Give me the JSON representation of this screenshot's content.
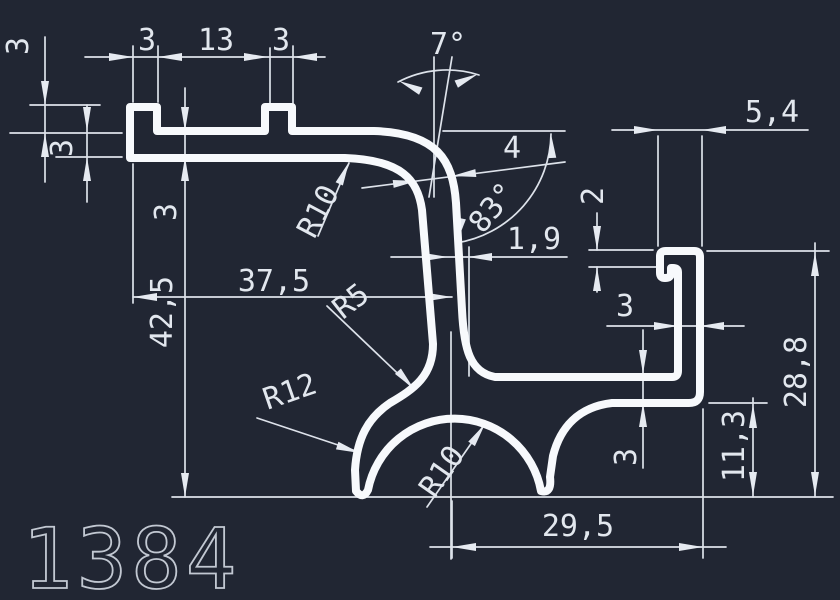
{
  "part_number": "1384",
  "colors": {
    "background": "#212633",
    "profile_line": "#f7f9fc",
    "dimension_line": "#dde2ea",
    "dimension_text": "#e2e7ee",
    "part_number_text": "#c2c8d2"
  },
  "dimensions": {
    "rib_left_width": "3",
    "rib_spacing": "13",
    "rib_right_width": "3",
    "flange_height": "3",
    "bar_thickness_left": "3",
    "bar_thickness_right": "3",
    "web_tilt_angle": "7°",
    "hook_overall_width": "5,4",
    "web_thickness": "4",
    "bend_angle": "83°",
    "hook_lip_thickness": "2",
    "lower_wall_thickness": "1,9",
    "bend_radius_top": "R10",
    "width_to_axis": "37,5",
    "junction_fillet_radius": "R5",
    "overall_height": "42,5",
    "leg_outer_radius": "R12",
    "arch_inner_radius": "R10",
    "right_wall_thickness": "3",
    "shelf_thickness": "3",
    "shelf_bottom_height": "11,3",
    "right_overall_height": "28,8",
    "bottom_width": "29,5"
  }
}
